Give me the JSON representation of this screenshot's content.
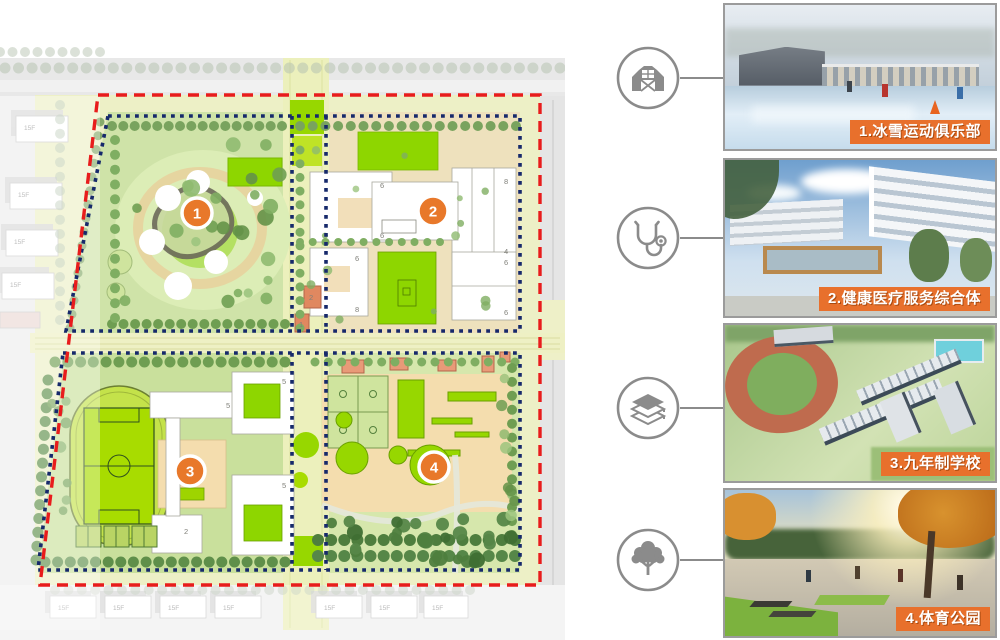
{
  "board_title": "masterplan-with-legend",
  "palette": {
    "accent_orange": "#E8702C",
    "marker_orange": "#E8782A",
    "boundary_red": "#E81C1C",
    "boundary_blue": "#16296B",
    "icon_gray": "#8B8B8B",
    "bright_green": "#97D700"
  },
  "plan": {
    "context_floor_label": "15F",
    "markers": [
      {
        "number": "1"
      },
      {
        "number": "2"
      },
      {
        "number": "3"
      },
      {
        "number": "4"
      }
    ],
    "q2_floor_labels": [
      "6",
      "6",
      "8",
      "4",
      "6",
      "8",
      "6",
      "6"
    ],
    "q3_floor_labels": [
      "5",
      "5",
      "5",
      "2"
    ],
    "corridor_building_labels": [
      "2",
      "1"
    ]
  },
  "legend": [
    {
      "id": "1",
      "icon": "barn-icon",
      "label": "1.冰雪运动俱乐部"
    },
    {
      "id": "2",
      "icon": "stethoscope-icon",
      "label": "2.健康医疗服务综合体"
    },
    {
      "id": "3",
      "icon": "books-icon",
      "label": "3.九年制学校"
    },
    {
      "id": "4",
      "icon": "tree-icon",
      "label": "4.体育公园"
    }
  ]
}
